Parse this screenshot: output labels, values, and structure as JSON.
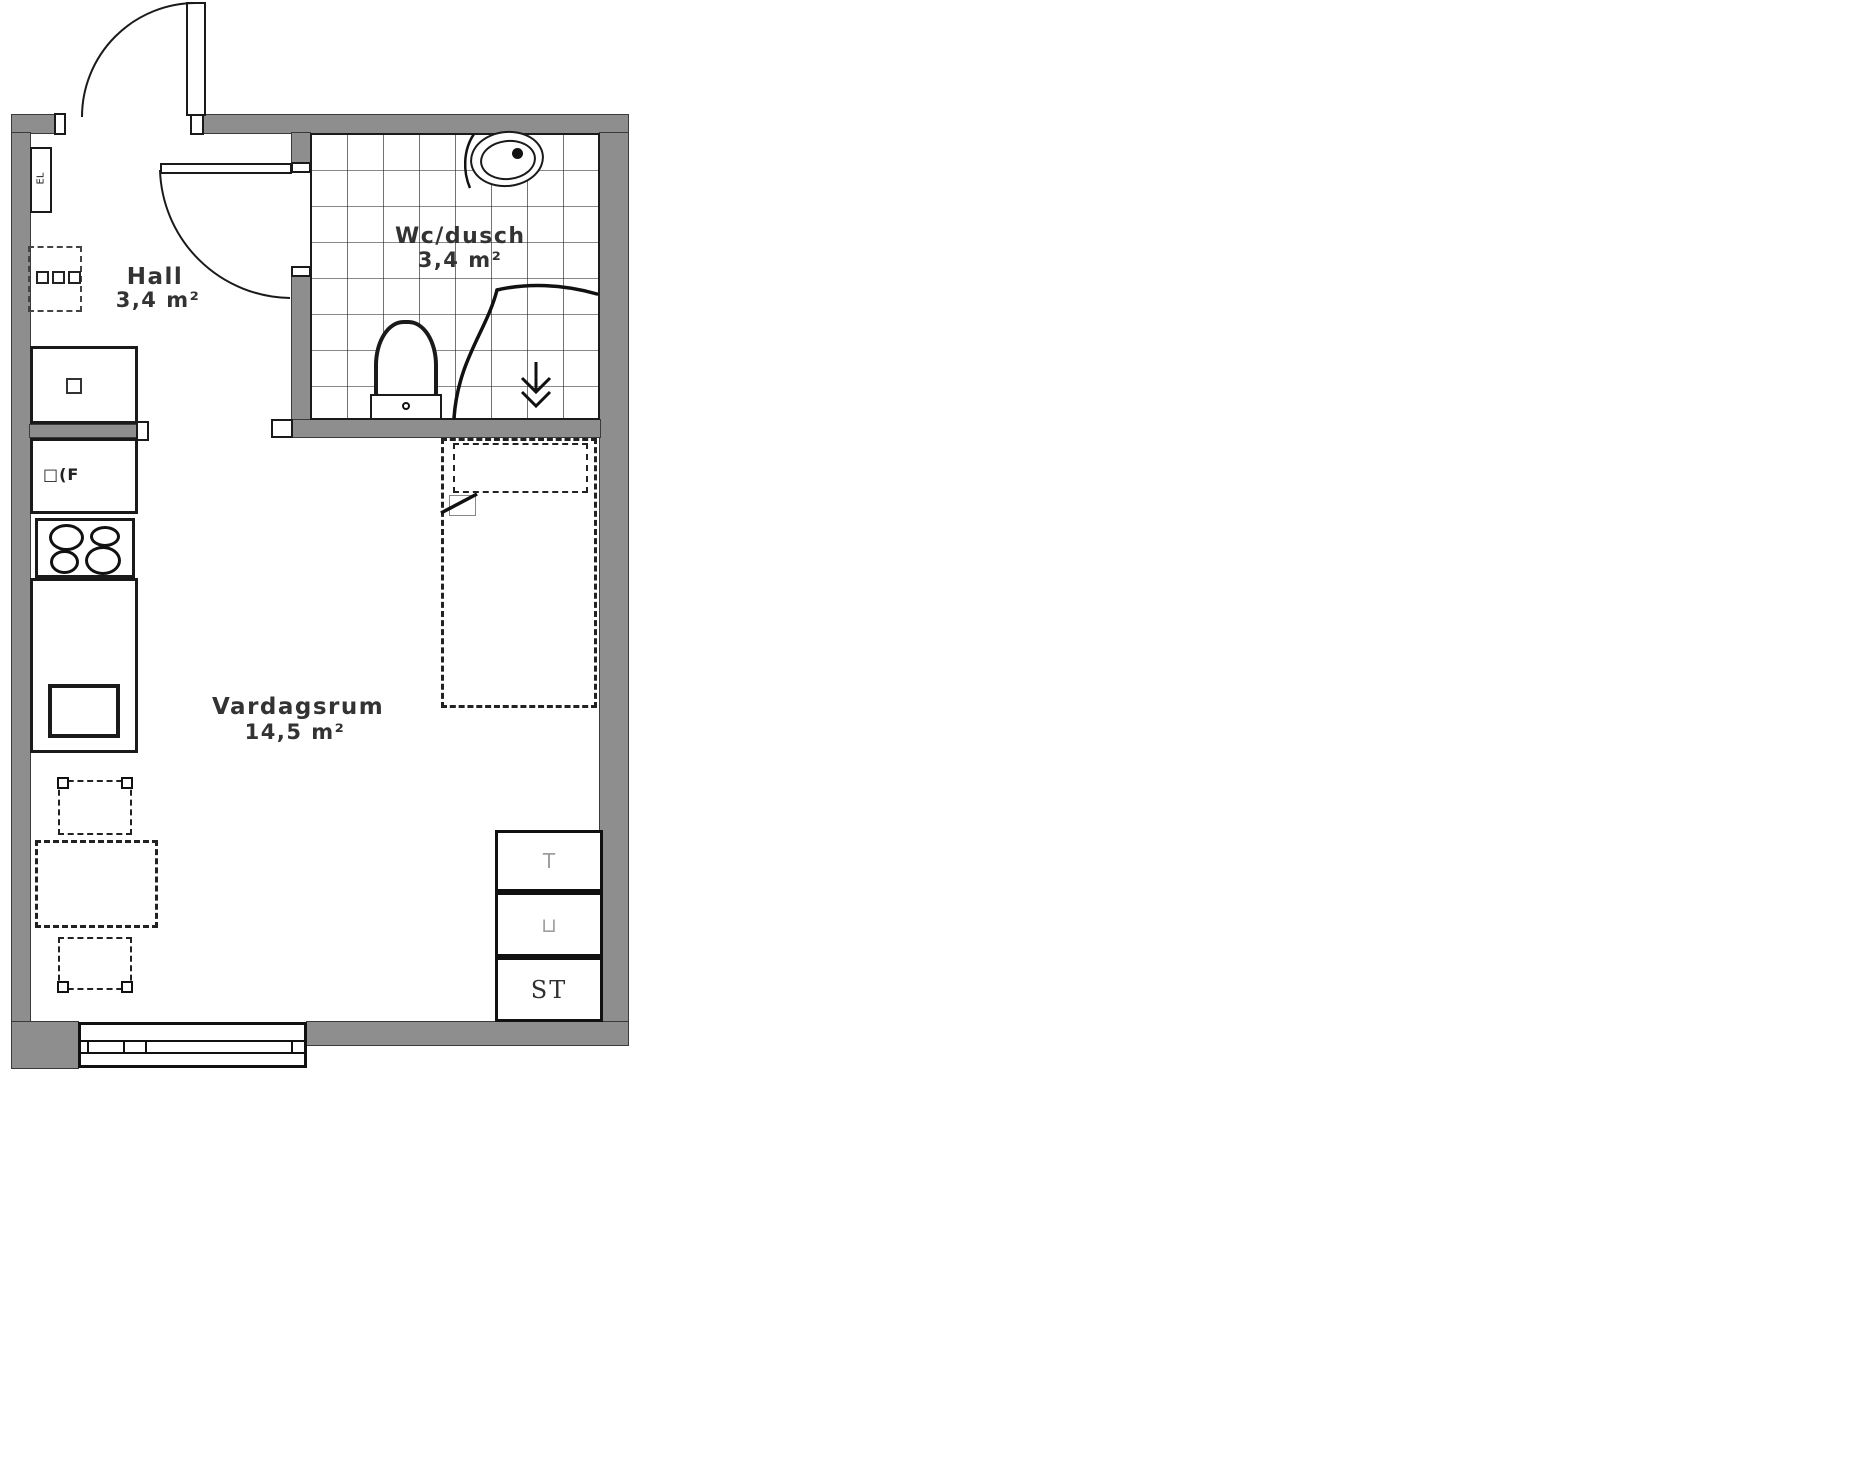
{
  "plan": {
    "rooms": [
      {
        "name": "Hall",
        "area": "3,4 m²"
      },
      {
        "name": "Wc/dusch",
        "area": "3,4 m²"
      },
      {
        "name": "Vardagsrum",
        "area": "14,5 m²"
      }
    ],
    "kitchen": {
      "fridge_label": "□(F"
    },
    "hall": {
      "el_panel_label": "EL"
    },
    "closets": {
      "top_label": "T",
      "middle_label": "⊔",
      "bottom_label": "ST"
    }
  },
  "colors": {
    "wall": "#8e8e8e",
    "line": "#1a1a1a",
    "faint": "#9e9e9e",
    "ink": "#333333"
  }
}
